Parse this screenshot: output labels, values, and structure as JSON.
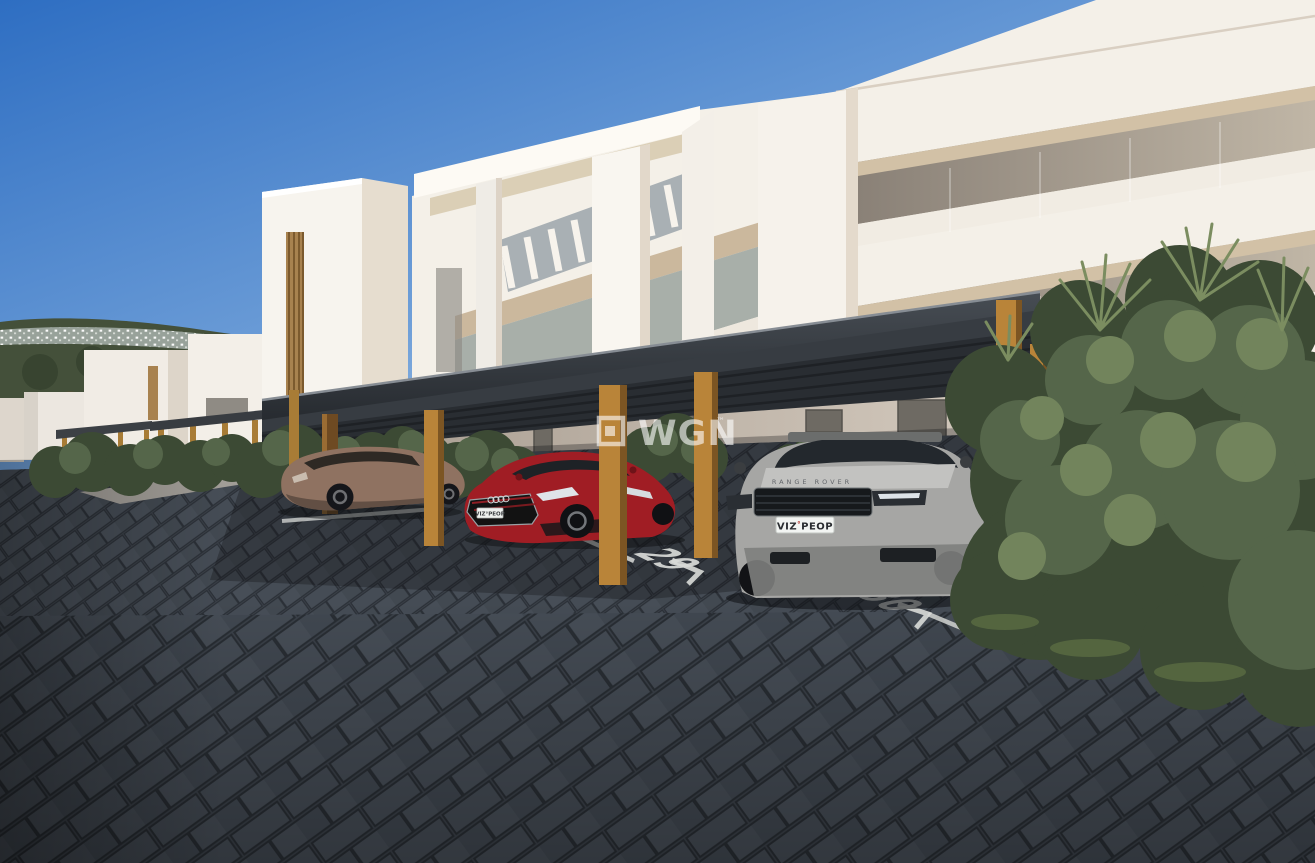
{
  "watermark": {
    "text": "WGN",
    "trademark": "™"
  },
  "parking": {
    "space_numbers": [
      "29",
      "30"
    ]
  },
  "vehicles": {
    "suv": {
      "hood_badge": "RANGE ROVER",
      "plate_left": "VIZ",
      "plate_sep": "°",
      "plate_right": "PEOP",
      "body_color": "#a6a6a4"
    },
    "sedan": {
      "plate": "VIZ°PEOP",
      "body_color": "#a01d24"
    },
    "hatchback": {
      "body_color": "#8f7261"
    }
  },
  "colors": {
    "sky_top": "#2e6ec2",
    "sky_mid": "#6f9fd8",
    "sky_horizon": "#cfe3f4",
    "building_white": "#f4f0e8",
    "carport_roof": "#373c42",
    "carport_soffit": "#292d32",
    "wood_light": "#b98439",
    "wood_dark": "#7c5523",
    "pavement": "#3d434b",
    "marking": "#d9dbd8",
    "foliage_hill": "#44503a",
    "foliage_dark": "#3c4a34",
    "foliage_mid": "#55664a",
    "foliage_light": "#72845c"
  }
}
